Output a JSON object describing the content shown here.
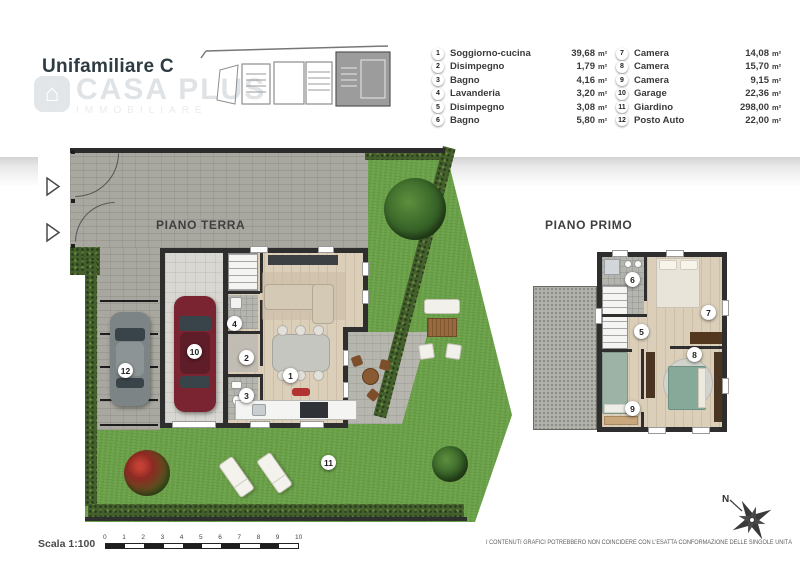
{
  "header": {
    "title": "Unifamiliare C"
  },
  "logo": {
    "brand": "CASA PLUS",
    "tagline": "IMMOBILIARE",
    "icon": "house-icon"
  },
  "legend": {
    "unit": "m²",
    "items": [
      {
        "num": "1",
        "name": "Soggiorno-cucina",
        "area": "39,68"
      },
      {
        "num": "2",
        "name": "Disimpegno",
        "area": "1,79"
      },
      {
        "num": "3",
        "name": "Bagno",
        "area": "4,16"
      },
      {
        "num": "4",
        "name": "Lavanderia",
        "area": "3,20"
      },
      {
        "num": "5",
        "name": "Disimpegno",
        "area": "3,08"
      },
      {
        "num": "6",
        "name": "Bagno",
        "area": "5,80"
      },
      {
        "num": "7",
        "name": "Camera",
        "area": "14,08"
      },
      {
        "num": "8",
        "name": "Camera",
        "area": "15,70"
      },
      {
        "num": "9",
        "name": "Camera",
        "area": "9,15"
      },
      {
        "num": "10",
        "name": "Garage",
        "area": "22,36"
      },
      {
        "num": "11",
        "name": "Giardino",
        "area": "298,00"
      },
      {
        "num": "12",
        "name": "Posto Auto",
        "area": "22,00"
      }
    ]
  },
  "plans": {
    "ground_label": "PIANO TERRA",
    "first_label": "PIANO PRIMO"
  },
  "footer": {
    "scale_label": "Scala 1:100",
    "scale_ticks": [
      "0",
      "1",
      "2",
      "3",
      "4",
      "5",
      "6",
      "7",
      "8",
      "9",
      "10"
    ],
    "disclaimer": "I CONTENUTI GRAFICI POTREBBERO NON COINCIDERE CON L'ESATTA CONFORMAZIONE DELLE SINGOLE UNITÀ",
    "north": "N"
  },
  "colors": {
    "title": "#2e3b42",
    "grass": "#6aa047",
    "hedge": "#44602c",
    "pavement": "#a8a8a0",
    "wall": "#2e2e2e",
    "red_car": "#7b2431",
    "gray_car": "#7d8486",
    "teal_bed": "#86a99a"
  }
}
